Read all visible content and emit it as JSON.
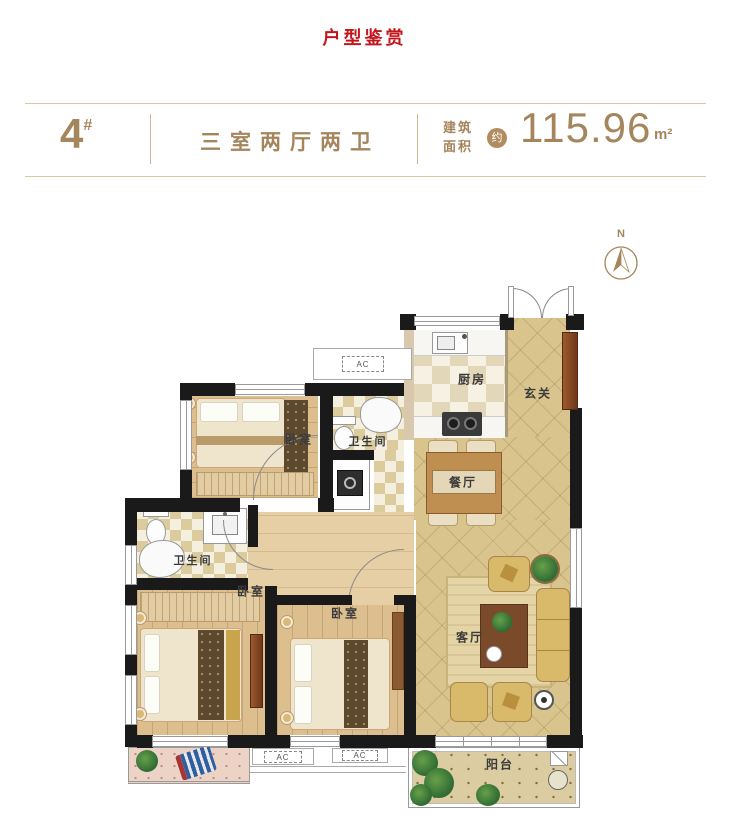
{
  "page": {
    "title": "户型鉴赏"
  },
  "header": {
    "unit_number": "4",
    "unit_suffix": "#",
    "layout_type": "三室两厅两卫",
    "area_label_line1": "建筑",
    "area_label_line2": "面积",
    "area_approx": "约",
    "area_value": "115.96",
    "area_unit": "m²"
  },
  "compass": {
    "north_label": "N"
  },
  "plan": {
    "room_labels": [
      {
        "id": "kitchen",
        "label": "厨房"
      },
      {
        "id": "entry",
        "label": "玄关"
      },
      {
        "id": "bath-top",
        "label": "卫生间"
      },
      {
        "id": "bedroom-top-left",
        "label": "卧室"
      },
      {
        "id": "bath-left",
        "label": "卫生间"
      },
      {
        "id": "bedroom-bottom-left",
        "label": "卧室"
      },
      {
        "id": "bedroom-bottom-middle",
        "label": "卧室"
      },
      {
        "id": "dining",
        "label": "餐厅"
      },
      {
        "id": "living",
        "label": "客厅"
      },
      {
        "id": "balcony",
        "label": "阳台"
      }
    ],
    "ac_units": [
      {
        "label": "AC"
      },
      {
        "label": "AC"
      },
      {
        "label": "AC"
      }
    ],
    "colors": {
      "accent": "#a5855c",
      "title_red": "#c3161c",
      "wall": "#1a1a1a",
      "tile": "#d9c48e",
      "wood": "#ddbe8e"
    }
  }
}
